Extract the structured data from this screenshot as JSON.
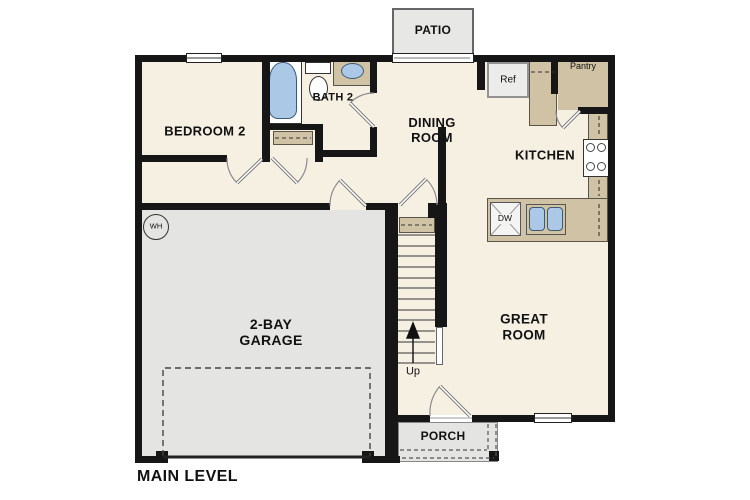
{
  "plan": {
    "title": "MAIN LEVEL",
    "rooms": {
      "patio": "PATIO",
      "bedroom2": "BEDROOM 2",
      "bath2": "BATH 2",
      "dining": "DINING\nROOM",
      "kitchen": "KITCHEN",
      "pantry": "Pantry",
      "garage": "2-BAY\nGARAGE",
      "great": "GREAT\nROOM",
      "porch": "PORCH"
    },
    "fixtures": {
      "ref": "Ref",
      "dw": "DW",
      "wh": "WH",
      "up": "Up"
    },
    "colors": {
      "floor": "#f6f0e3",
      "garage_floor": "#e4e4e2",
      "counter_tan": "#d0c3a5",
      "wall": "#161616",
      "fixture_blue": "#abc8e6"
    }
  }
}
